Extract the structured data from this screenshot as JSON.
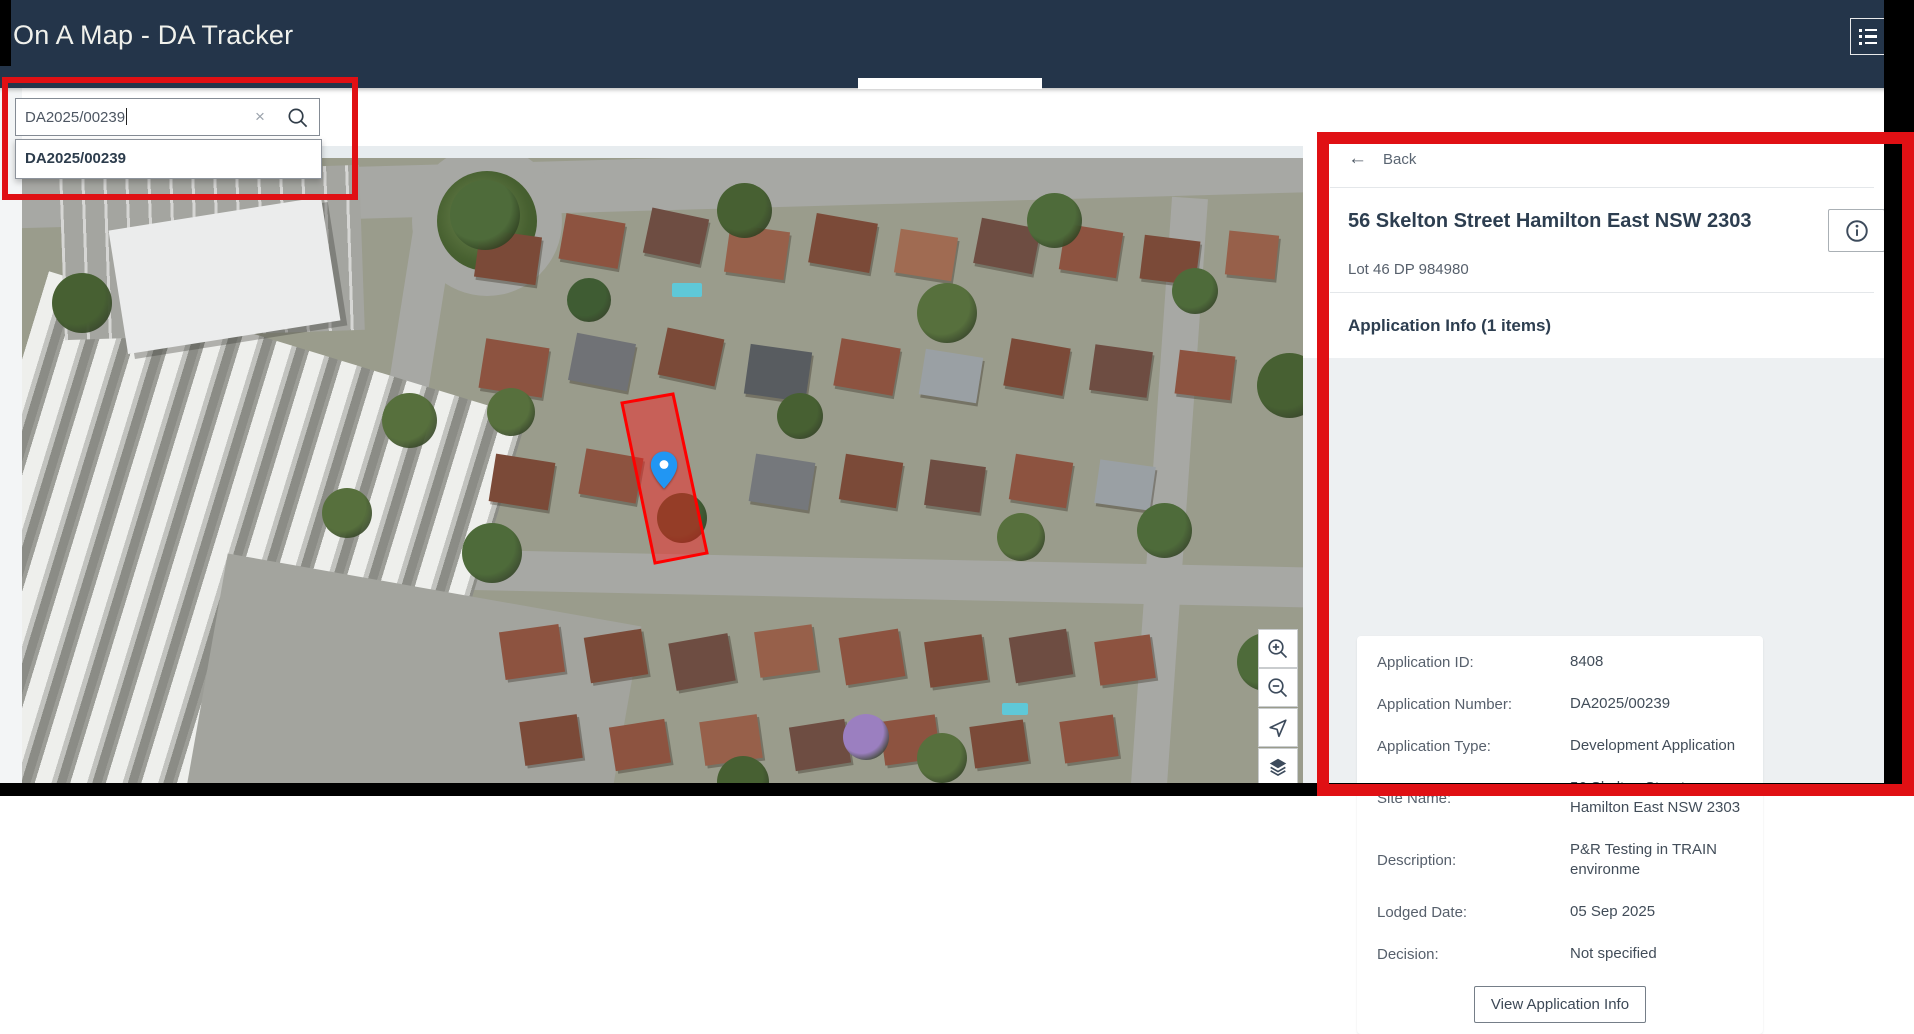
{
  "header": {
    "title": "On A Map - DA Tracker",
    "menu_button_icon": "list-icon"
  },
  "search": {
    "value": "DA2025/00239",
    "clear_icon": "×",
    "search_icon": "magnifier-icon",
    "suggestions": [
      "DA2025/00239"
    ]
  },
  "map": {
    "marker_icon": "location-pin-icon",
    "highlight_color": "#ff0000",
    "controls": [
      {
        "name": "zoom-in"
      },
      {
        "name": "zoom-out"
      },
      {
        "name": "locate"
      },
      {
        "name": "layers"
      }
    ]
  },
  "panel": {
    "back_icon": "←",
    "back_label": "Back",
    "site_title": "56 Skelton Street Hamilton East NSW 2303",
    "info_icon": "info-circle-icon",
    "lot_reference": "Lot 46 DP 984980",
    "section_heading": "Application Info (1 items)",
    "fields": [
      {
        "label": "Application ID:",
        "value": "8408"
      },
      {
        "label": "Application Number:",
        "value": "DA2025/00239"
      },
      {
        "label": "Application Type:",
        "value": "Development Application"
      },
      {
        "label": "Site Name:",
        "value": "56 Skelton Street Hamilton East NSW 2303"
      },
      {
        "label": "Description:",
        "value": "P&R Testing in TRAIN environme"
      },
      {
        "label": "Lodged Date:",
        "value": "05 Sep 2025"
      },
      {
        "label": "Decision:",
        "value": "Not specified"
      }
    ],
    "view_button_label": "View Application Info"
  },
  "annotations": {
    "color": "#e01014",
    "regions": [
      "search-area",
      "detail-panel"
    ]
  }
}
